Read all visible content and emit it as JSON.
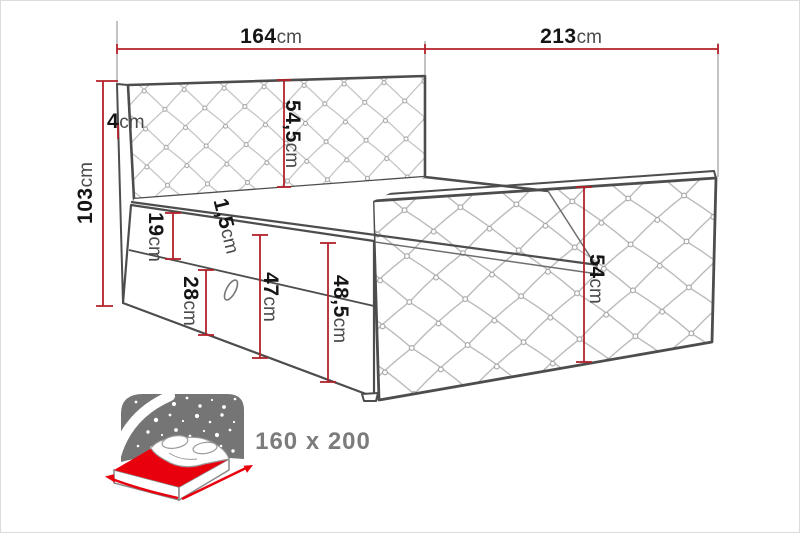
{
  "diagram": {
    "title_implicit": "bed-dimension-diagram",
    "dimensions": {
      "headboard_width": {
        "value": "164",
        "unit": "cm"
      },
      "bed_length": {
        "value": "213",
        "unit": "cm"
      },
      "headboard_height": {
        "value": "103",
        "unit": "cm"
      },
      "headboard_thicknessو": {
        "value": "",
        "unit": ""
      },
      "headboard_thickness": {
        "value": "4",
        "unit": "cm"
      },
      "headboard_panel": {
        "value": "54,5",
        "unit": "cm"
      },
      "top_rail": {
        "value": "19",
        "unit": "cm"
      },
      "mattress_lip": {
        "value": "1,5",
        "unit": "cm"
      },
      "drawer_front": {
        "value": "28",
        "unit": "cm"
      },
      "base_height": {
        "value": "47",
        "unit": "cm"
      },
      "base_total_height": {
        "value": "48,5",
        "unit": "cm"
      },
      "footboard_height": {
        "value": "54",
        "unit": "cm"
      }
    },
    "badge": {
      "size_label": "160 x 200"
    },
    "colors": {
      "dimension_red": "#b4212a",
      "outline_gray": "#4d4d4d",
      "lattice_gray": "#bcbcbc",
      "icon_red": "#e8000d",
      "icon_gray": "#757575",
      "size_text_gray": "#7c7c7c"
    }
  }
}
